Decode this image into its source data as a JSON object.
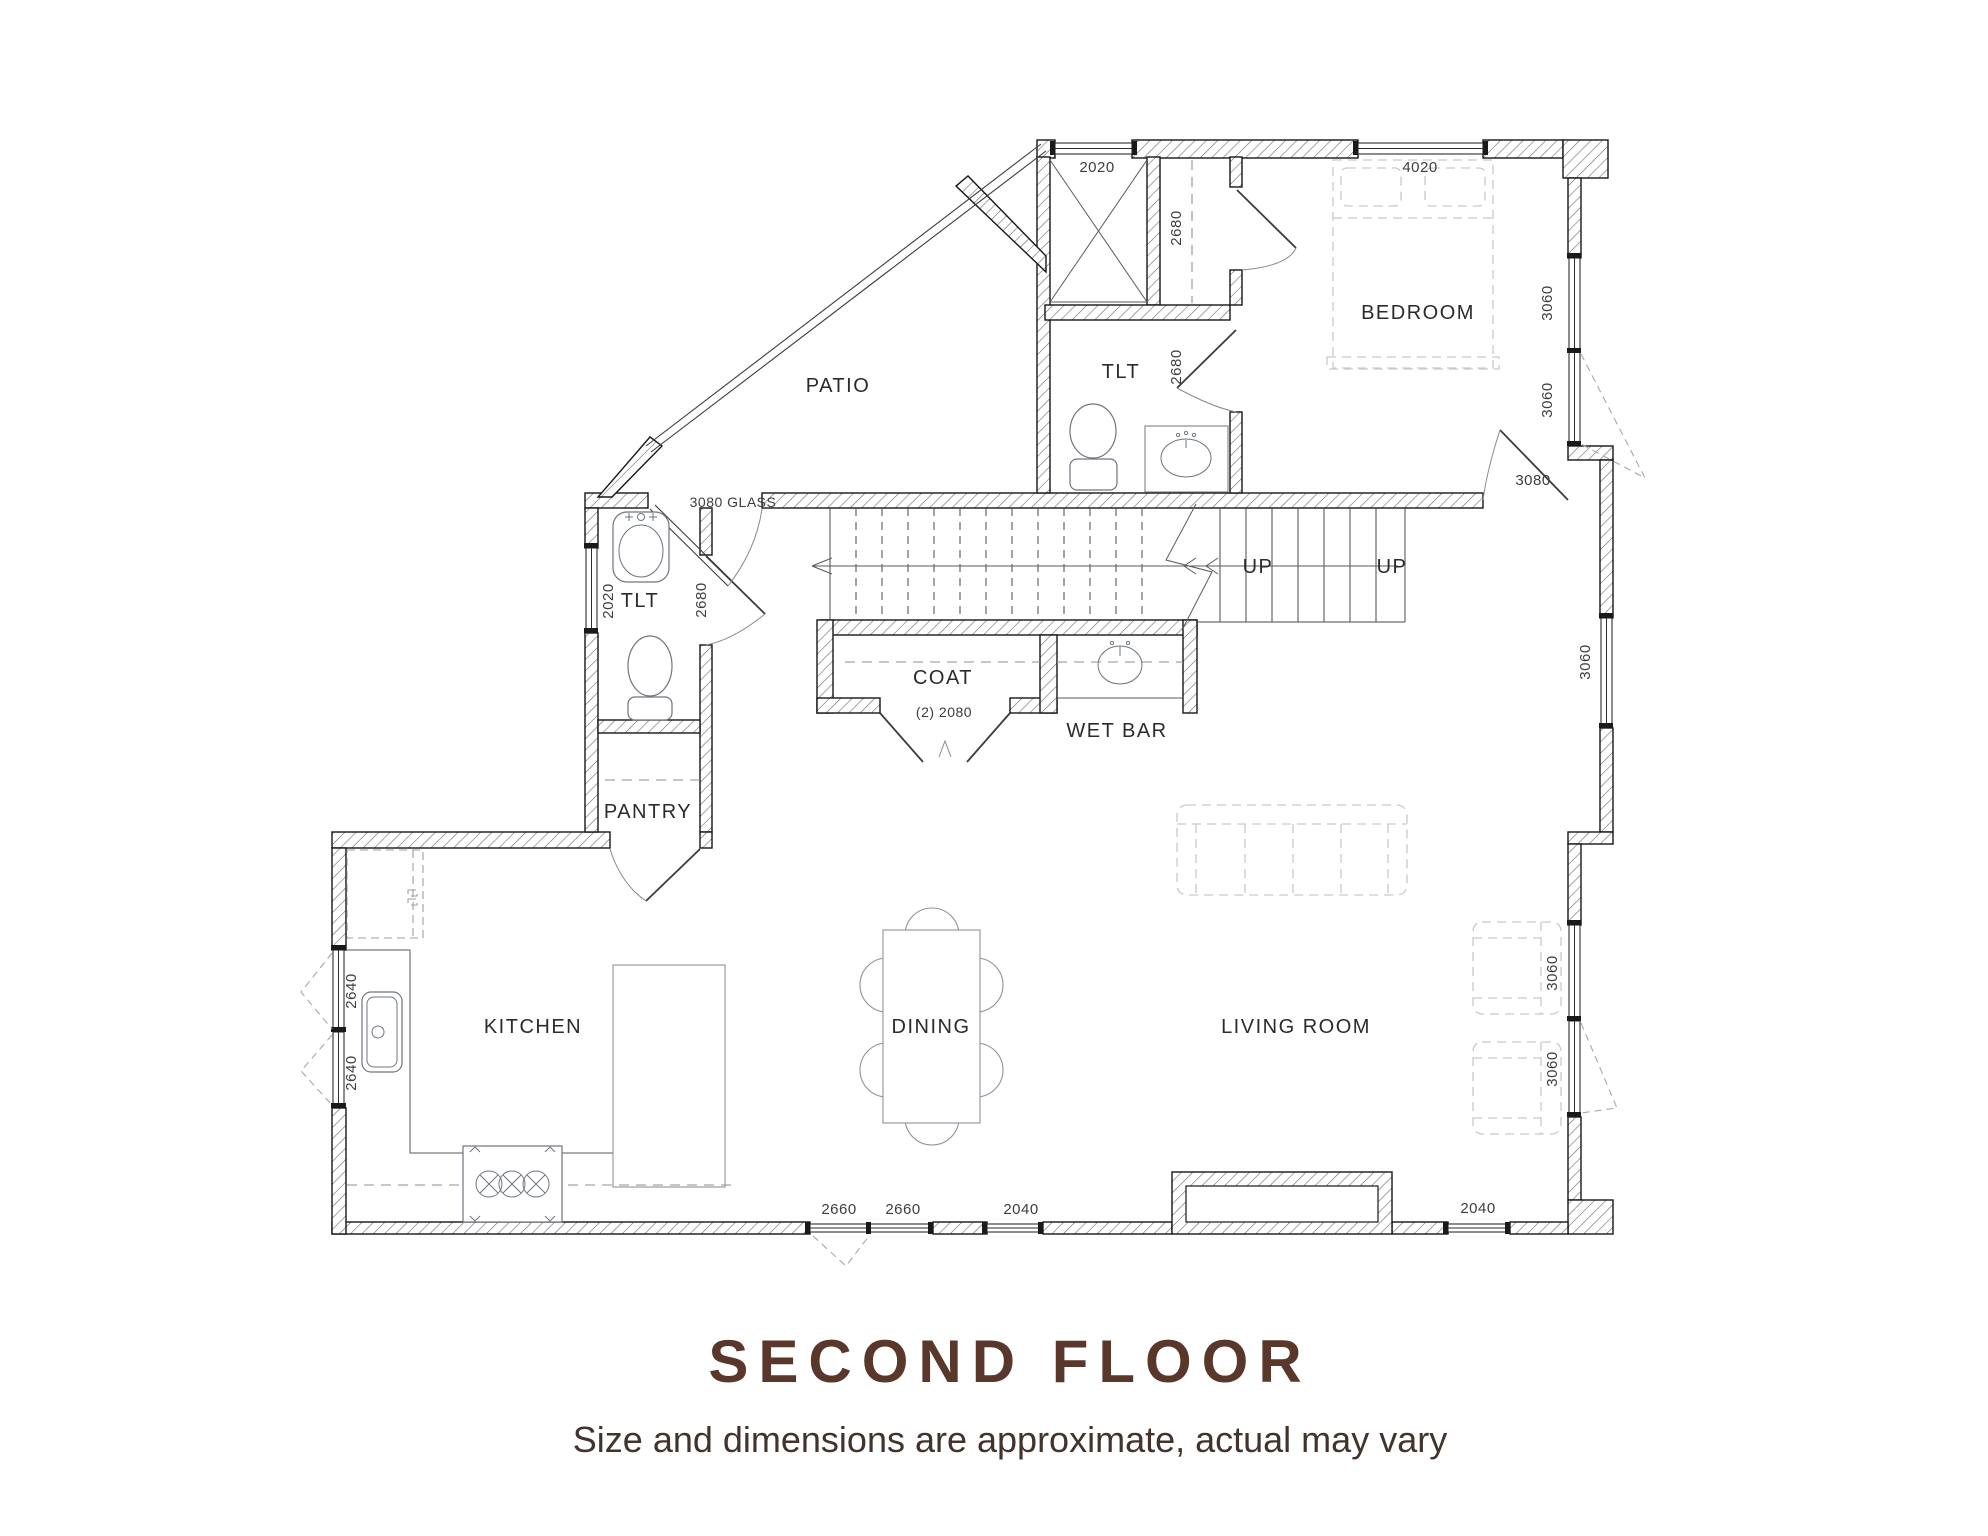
{
  "title": {
    "heading": "SECOND FLOOR",
    "subtitle": "Size and dimensions are approximate, actual may vary",
    "heading_color": "#59372b"
  },
  "plan": {
    "rooms": {
      "patio": "PATIO",
      "toilet_upper": "TLT",
      "bedroom": "BEDROOM",
      "toilet_left": "TLT",
      "coat": "COAT",
      "wet_bar": "WET BAR",
      "pantry": "PANTRY",
      "kitchen": "KITCHEN",
      "dining": "DINING",
      "living_room": "LIVING ROOM"
    },
    "stairs": {
      "up_left": "UP",
      "up_right": "UP"
    },
    "dimensions": {
      "closet_window": "2020",
      "bedroom_window": "4020",
      "closet_door": "2680",
      "upper_toilet_door": "2680",
      "bedroom_right_window_upper": "3060",
      "bedroom_right_window_lower": "3060",
      "bedroom_door": "3080",
      "patio_glass_door": "3080 GLASS",
      "left_toilet_window": "2020",
      "left_toilet_door": "2680",
      "living_right_window_upper": "3060",
      "coat_doors": "(2) 2080",
      "kitchen_window_upper": "2640",
      "kitchen_window_lower": "2640",
      "living_right_window_mid": "3060",
      "living_right_window_bottom": "3060",
      "patio_door_south": "2660",
      "dining_window_south": "2660",
      "living_window_south_left": "2040",
      "living_window_south_right": "2040"
    }
  }
}
